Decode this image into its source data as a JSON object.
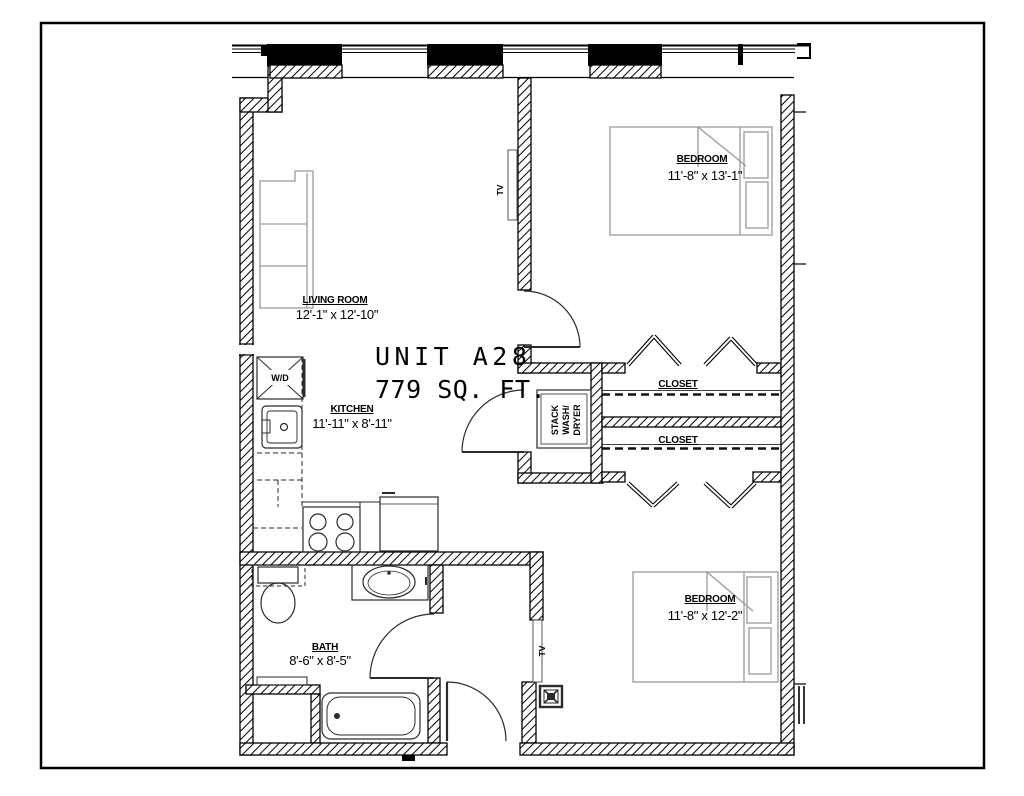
{
  "plan": {
    "unit_title": "UNIT A28",
    "unit_area": "779 SQ. FT.",
    "rooms": [
      {
        "name": "LIVING ROOM",
        "dims": "12'-1\" x 12'-10\""
      },
      {
        "name": "KITCHEN",
        "dims": "11'-11\" x 8'-11\""
      },
      {
        "name": "BATH",
        "dims": "8'-6\" x 8'-5\""
      },
      {
        "name": "BEDROOM",
        "dims": "11'-8\" x 13'-1\""
      },
      {
        "name": "BEDROOM",
        "dims": "11'-8\" x 12'-2\""
      }
    ],
    "closet1_label": "CLOSET",
    "closet2_label": "CLOSET",
    "laundry": {
      "line1": "STACK",
      "line2": "WASH/",
      "line3": "DRYER"
    },
    "wd_label": "W/D",
    "tv_label_living": "TV",
    "tv_label_bedroom": "TV",
    "colors": {
      "ink": "#000000",
      "furniture_gray": "#9a9a9a",
      "fixture": "#2a2a2a",
      "paper": "#ffffff"
    }
  }
}
